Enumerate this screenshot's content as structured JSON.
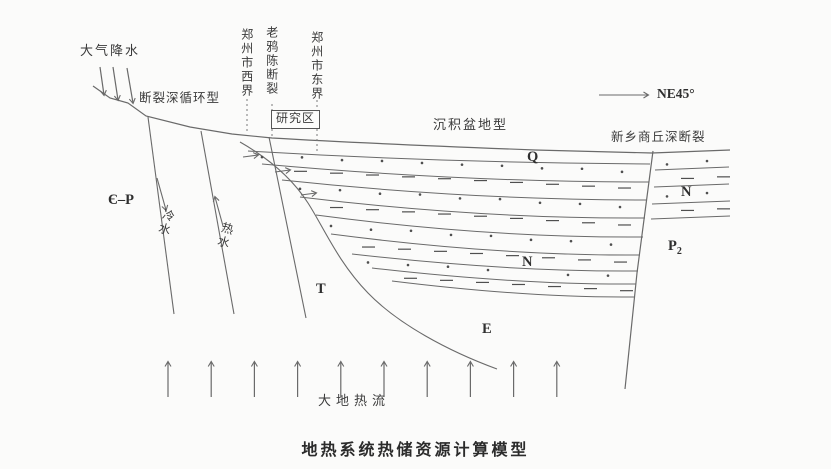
{
  "figure": {
    "caption": "地热系统热储资源计算模型",
    "labels": {
      "precipitation": "大气降水",
      "fault_circulation_type": "断裂深循环型",
      "zhengzhou_west_boundary": "郑州市西界",
      "laoyachen_fault": "老鸦陈断裂",
      "zhengzhou_east_boundary": "郑州市东界",
      "study_area": "研究区",
      "sedimentary_basin_type": "沉积盆地型",
      "xinxiang_shangqiu_fault": "新乡商丘深断裂",
      "direction": "NE45°",
      "cambrian_permian": "Є–P",
      "cold_water": "冷水",
      "hot_water": "热水",
      "terrestrial_heat_flow": "大地热流"
    },
    "strata": {
      "quaternary": "Q",
      "neogene_right": "N",
      "neogene_center": "N",
      "permian_main": "P",
      "permian_sub": "2",
      "triassic": "T",
      "eogene": "E"
    },
    "decorations": {
      "rain_arrow_count": 3,
      "heat_flow_arrow_count": 10,
      "pinchout_arrow_count": 3
    },
    "colors": {
      "line": "#6a6a6a",
      "symbol": "#4f4f4f",
      "text": "#3a3a3a",
      "background": "#fbfbfa"
    }
  }
}
